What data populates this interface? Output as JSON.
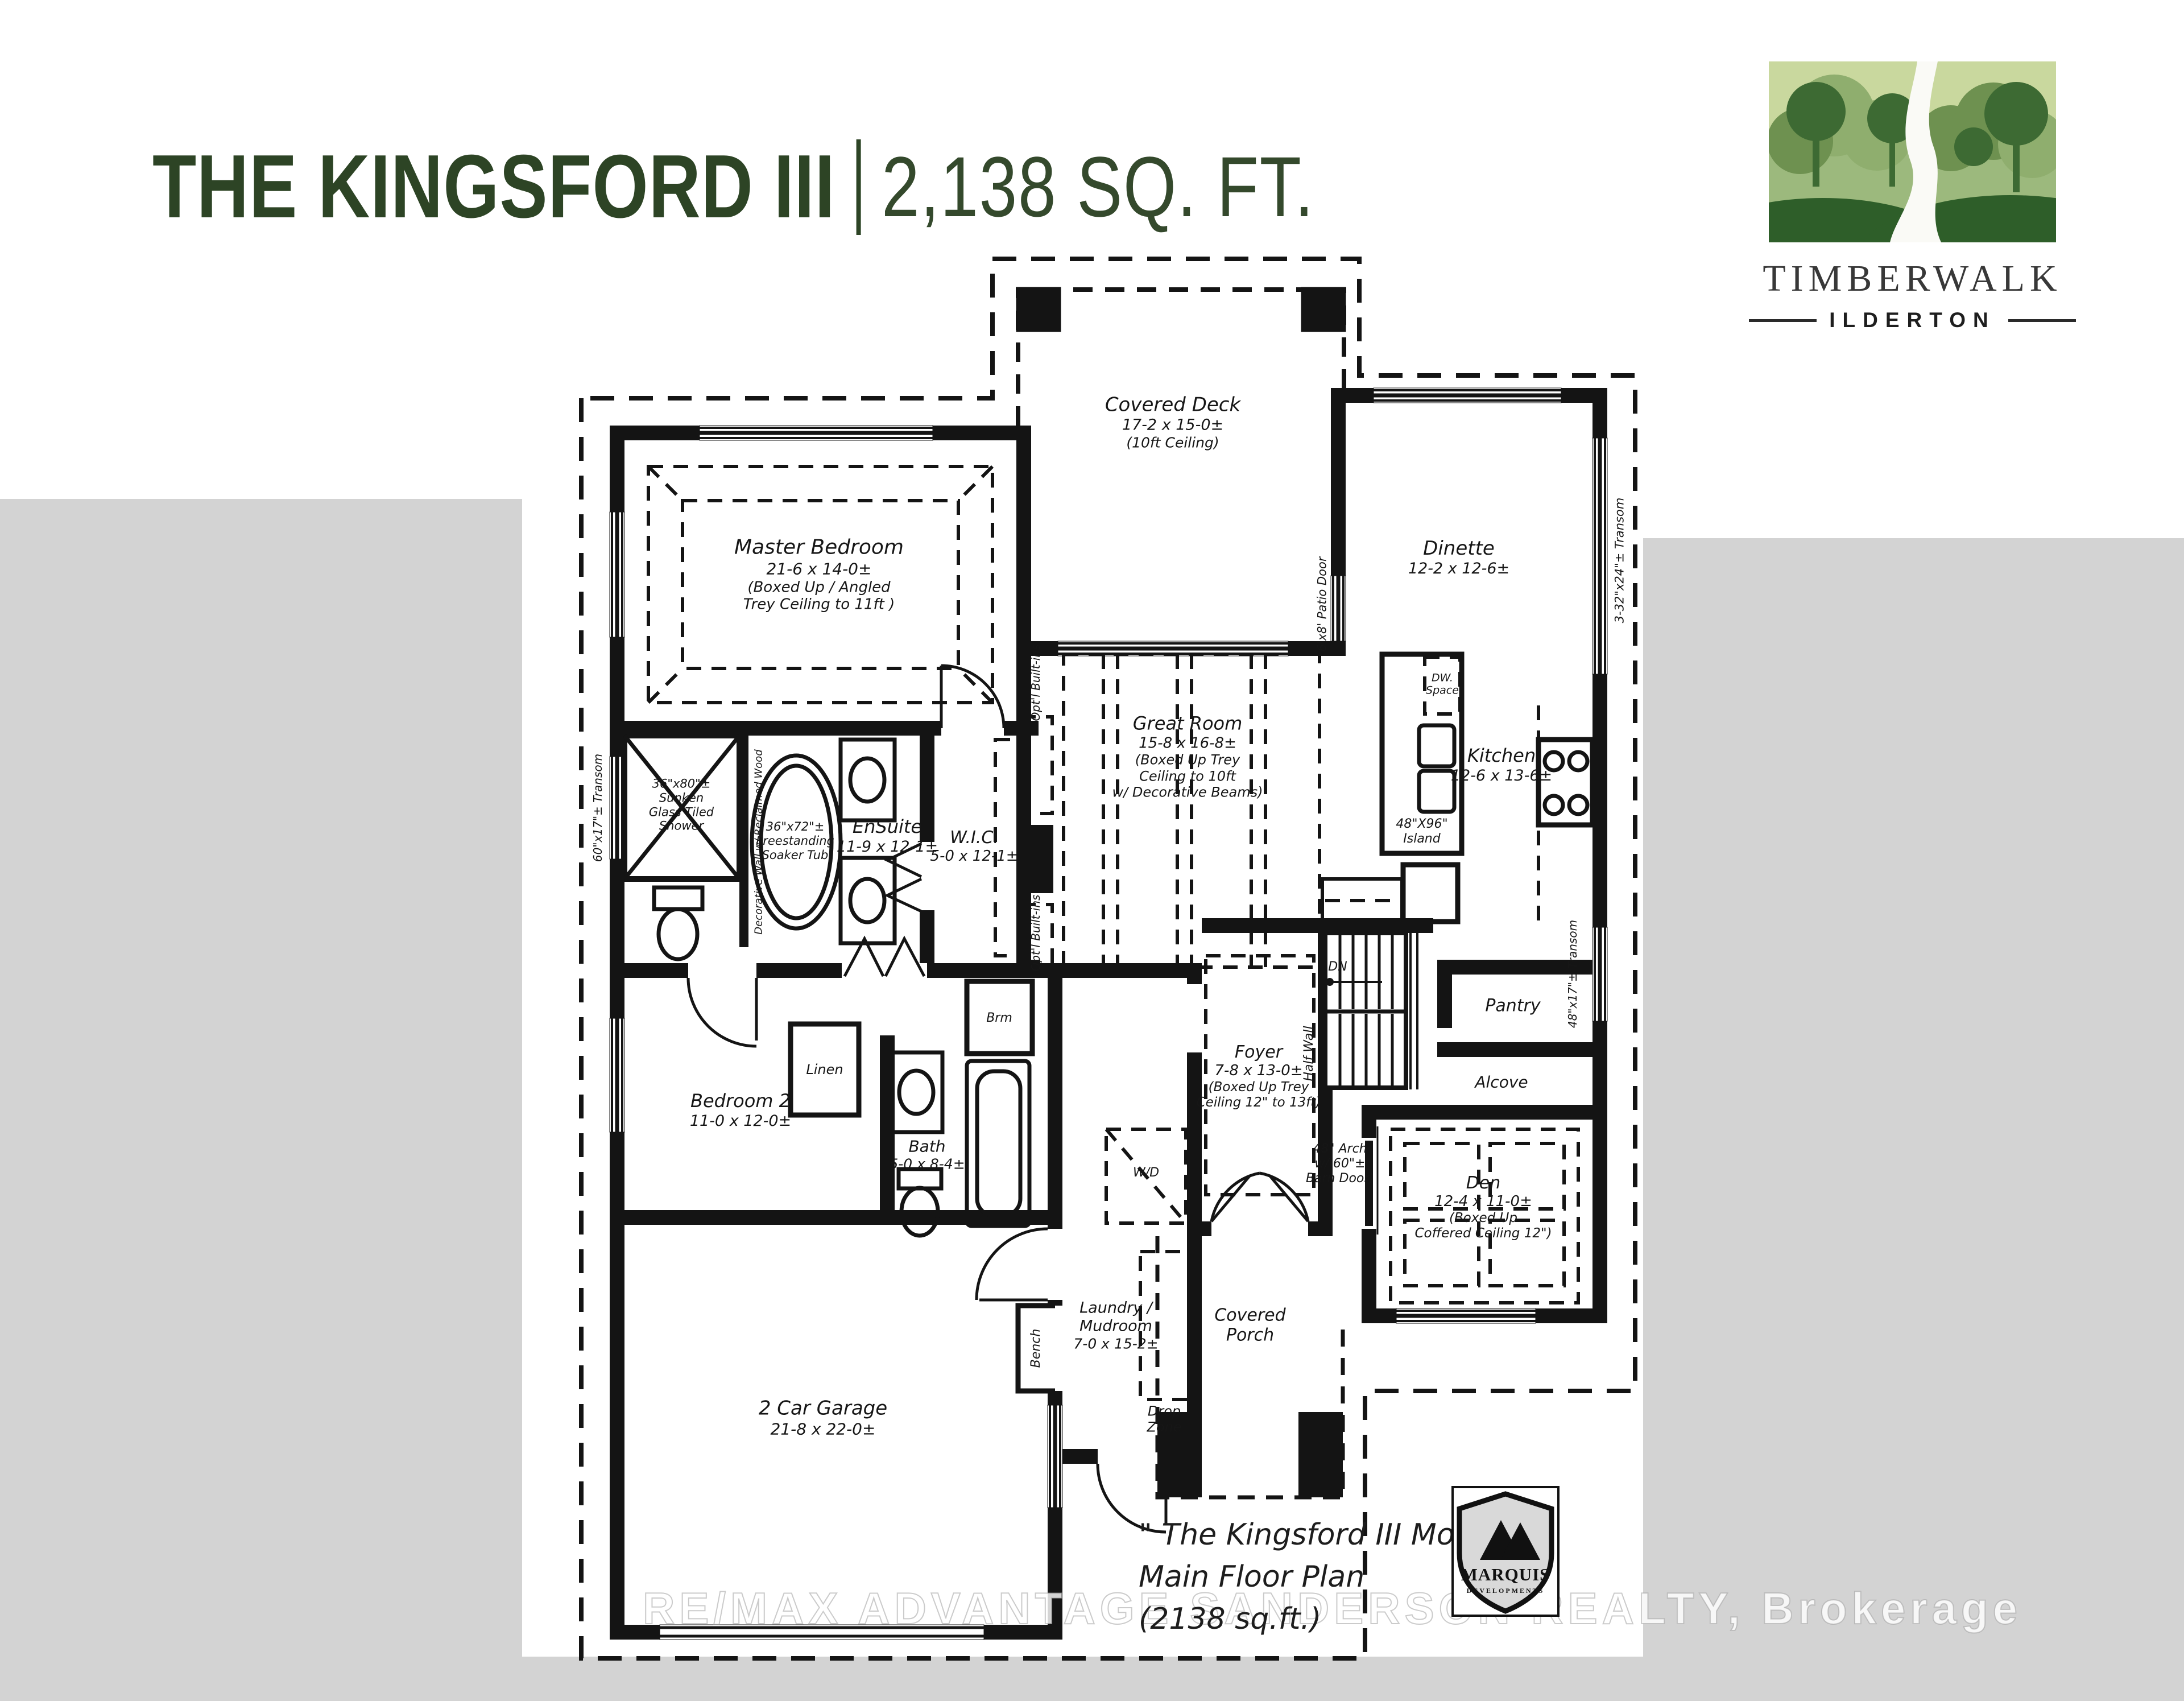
{
  "colors": {
    "title-green": "#2d4425",
    "sqft-green": "#34492c",
    "page-gray": "#d3d3d3",
    "ink": "#141414",
    "logo-sky": "#c9d89e",
    "logo-dark": "#3d6a33",
    "logo-mid": "#6e9150",
    "logo-light": "#8fae6e",
    "logo-hill": "#2e5e29"
  },
  "header": {
    "title": "THE KINGSFORD III",
    "sqft": "2,138 SQ. FT."
  },
  "brand": {
    "name": "TIMBERWALK",
    "location": "ILDERTON"
  },
  "rooms": {
    "covered_deck": {
      "name": "Covered Deck",
      "dim": "17-2 x 15-0±",
      "note": "(10ft Ceiling)"
    },
    "dinette": {
      "name": "Dinette",
      "dim": "12-2 x 12-6±"
    },
    "master": {
      "name": "Master Bedroom",
      "dim": "21-6 x 14-0±",
      "n1": "(Boxed Up / Angled",
      "n2": "Trey Ceiling to 11ft )"
    },
    "great_room": {
      "name": "Great Room",
      "dim": "15-8 x 16-8±",
      "n1": "(Boxed Up Trey",
      "n2": "Ceiling to 10ft",
      "n3": "w/ Decorative Beams)"
    },
    "kitchen": {
      "name": "Kitchen",
      "dim": "12-6 x 13-6±"
    },
    "island": {
      "l1": "48\"X96\"",
      "l2": "Island"
    },
    "dw": {
      "l1": "DW.",
      "l2": "Space"
    },
    "pantry": {
      "name": "Pantry"
    },
    "alcove": {
      "name": "Alcove"
    },
    "ensuite": {
      "name": "EnSuite",
      "dim": "11-9 x 12-1±"
    },
    "wic": {
      "name": "W.I.C.",
      "dim": "5-0 x 12-1±"
    },
    "shower": {
      "l1": "36\"x80\"±",
      "l2": "Sunken",
      "l3": "Glass Tiled",
      "l4": "Shower"
    },
    "tub": {
      "l1": "36\"x72\"±",
      "l2": "Freestanding",
      "l3": "Soaker Tub"
    },
    "bedroom2": {
      "name": "Bedroom 2",
      "dim": "11-0 x 12-0±"
    },
    "bath": {
      "name": "Bath",
      "dim": "5-0 x 8-4±"
    },
    "linen": {
      "name": "Linen"
    },
    "brm": {
      "name": "Brm"
    },
    "laundry": {
      "l1": "Laundry /",
      "l2": "Mudroom",
      "dim": "7-0 x 15-2±"
    },
    "wd": {
      "name": "W/D"
    },
    "drop_zone": {
      "l1": "Drop",
      "l2": "Zone"
    },
    "bench": {
      "name": "Bench"
    },
    "foyer": {
      "name": "Foyer",
      "dim": "7-8 x 13-0±",
      "n1": "(Boxed Up Trey",
      "n2": "Ceiling 12\" to 13ft)"
    },
    "den": {
      "name": "Den",
      "dim": "12-4 x 11-0±",
      "n1": "(Boxed Up",
      "n2": "Coffered Ceiling 12\")"
    },
    "arch": {
      "l1": "48\" Arch",
      "l2": "w/ 60\"±",
      "l3": "Barn Door)"
    },
    "porch": {
      "l1": "Covered",
      "l2": "Porch"
    },
    "garage": {
      "name": "2 Car Garage",
      "dim": "21-8 x 22-0±"
    }
  },
  "stairs": {
    "dn": "DN",
    "half_wall": "Half Wall"
  },
  "annotations": {
    "patio_door": "6'x8' Patio Door",
    "transom_dinette": "3-32\"x24\"± Transom",
    "transom_kitchen": "48\"x17\"± Transom",
    "transom_ensuite": "60\"x17\"± Transom",
    "builtins_upper": "Opt'l Built-ins",
    "builtins_lower": "Opt'l Built-ins",
    "feature_wall": "Decorative Wall w/ Reclaimed Wood"
  },
  "footer": {
    "model": "\" The Kingsford III Model \"",
    "plan": "Main Floor Plan",
    "sqft": "(2138 sq.ft.)"
  },
  "builder": {
    "name": "MARQUIS",
    "sub": "DEVELOPMENTS"
  },
  "watermark": "RE/MAX ADVANTAGE SANDERSON REALTY, Brokerage"
}
